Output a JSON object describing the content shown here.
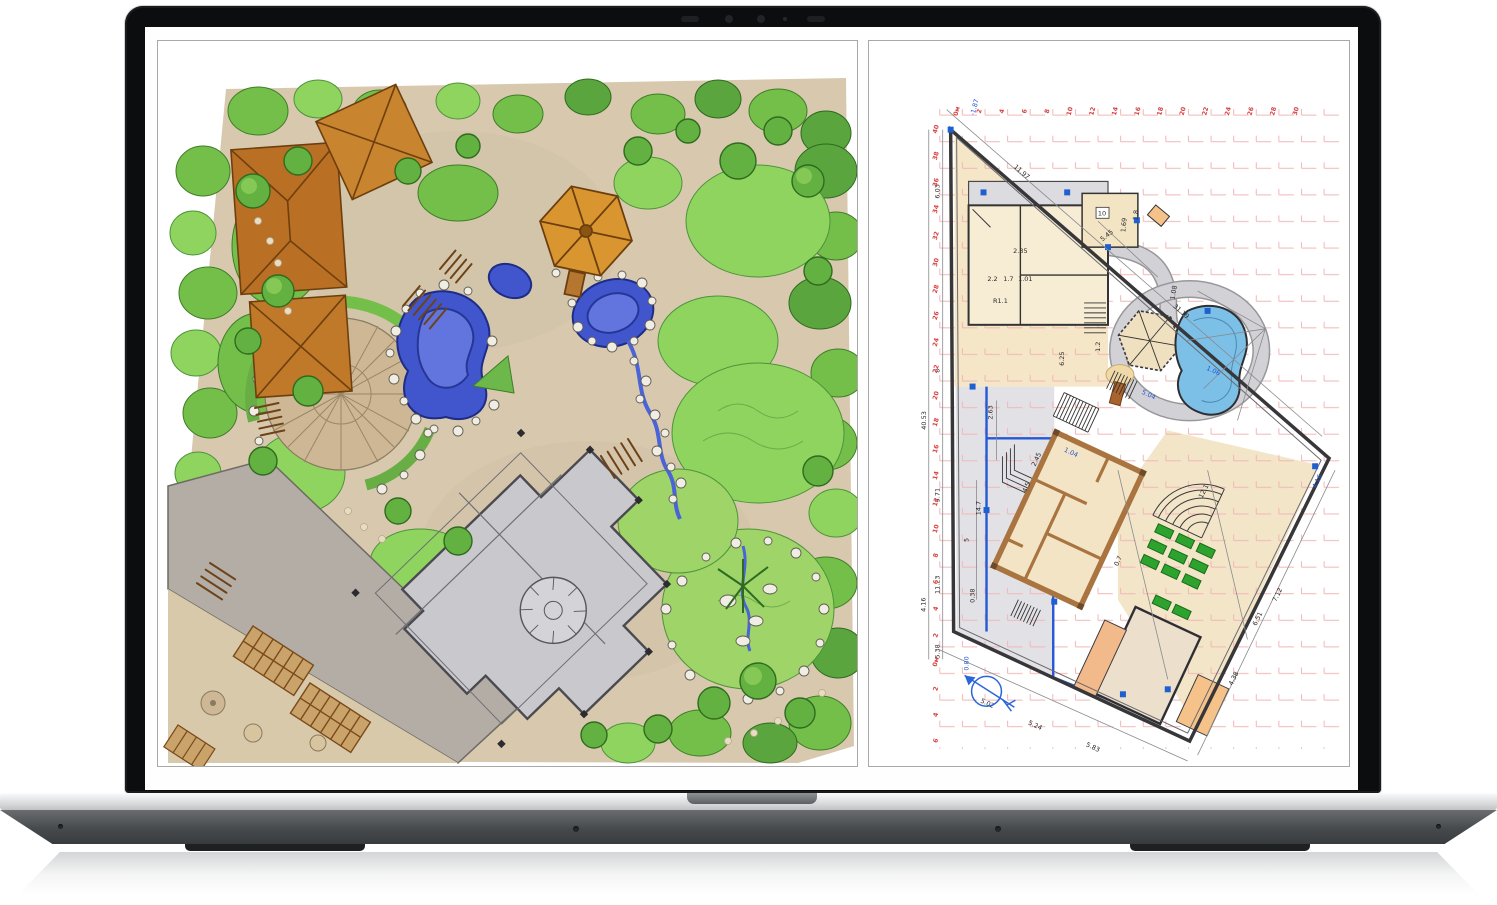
{
  "mockup": {
    "device": "laptop",
    "camera_icons": [
      "ir-emitter-icon",
      "webcam-icon",
      "ambient-light-sensor-icon",
      "camera-led-icon",
      "ir-emitter-icon"
    ]
  },
  "panels": {
    "left": {
      "name": "hand-drawn-landscape-masterplan"
    },
    "right": {
      "name": "cad-site-plan"
    }
  },
  "colors": {
    "bezel": "#0c0d0f",
    "deck_silver": "#d6d8da",
    "base_dark": "#474a4d",
    "cad_red": "#d94040",
    "cad_blue": "#2356d6",
    "pool_blue": "#7cc0e8",
    "bed_green": "#2ea22e",
    "wall_brown": "#a9743f",
    "room_beige": "#f3e4c6",
    "water_blue": "#4156cc",
    "foliage_green": "#74bf4a",
    "ground_tan": "#d8c9ae",
    "roof_brown": "#bf7326"
  },
  "cad": {
    "scale_top": [
      "0м",
      "2",
      "4",
      "6",
      "8",
      "10",
      "12",
      "14",
      "16",
      "18",
      "20",
      "22",
      "24",
      "26",
      "28",
      "30"
    ],
    "scale_left": [
      "40",
      "38",
      "36",
      "34",
      "32",
      "30",
      "28",
      "26",
      "24",
      "22",
      "20",
      "18",
      "16",
      "14",
      "12",
      "10",
      "8",
      "6",
      "4",
      "2",
      "0м"
    ],
    "scale_left_below": [
      "2",
      "4",
      "6"
    ],
    "room_label": "10",
    "dims": {
      "left_chain": [
        "6.03",
        "8",
        "5.71",
        "40.53",
        "4.16",
        "11.23",
        "5.38"
      ],
      "top_chain": [
        "11.97",
        "31.19"
      ],
      "right_chain": [
        "7.12",
        "4.38"
      ],
      "bottom_chain": [
        "5.02",
        "5.24",
        "5.83"
      ],
      "interior": [
        "14.7",
        "5",
        "0.38",
        "2.63",
        "6.25",
        "R1.1",
        "2.35",
        "5.45",
        "1.69",
        "1.8",
        "1.08",
        "2.45",
        "4.5",
        "0.7",
        "12.1",
        "6.51",
        "2.2",
        "1.7",
        "1.01",
        "1.2"
      ],
      "blue_levels": [
        "-1.87",
        "4.16",
        "1.04",
        "5.04",
        "0.80",
        "1.06"
      ]
    }
  }
}
